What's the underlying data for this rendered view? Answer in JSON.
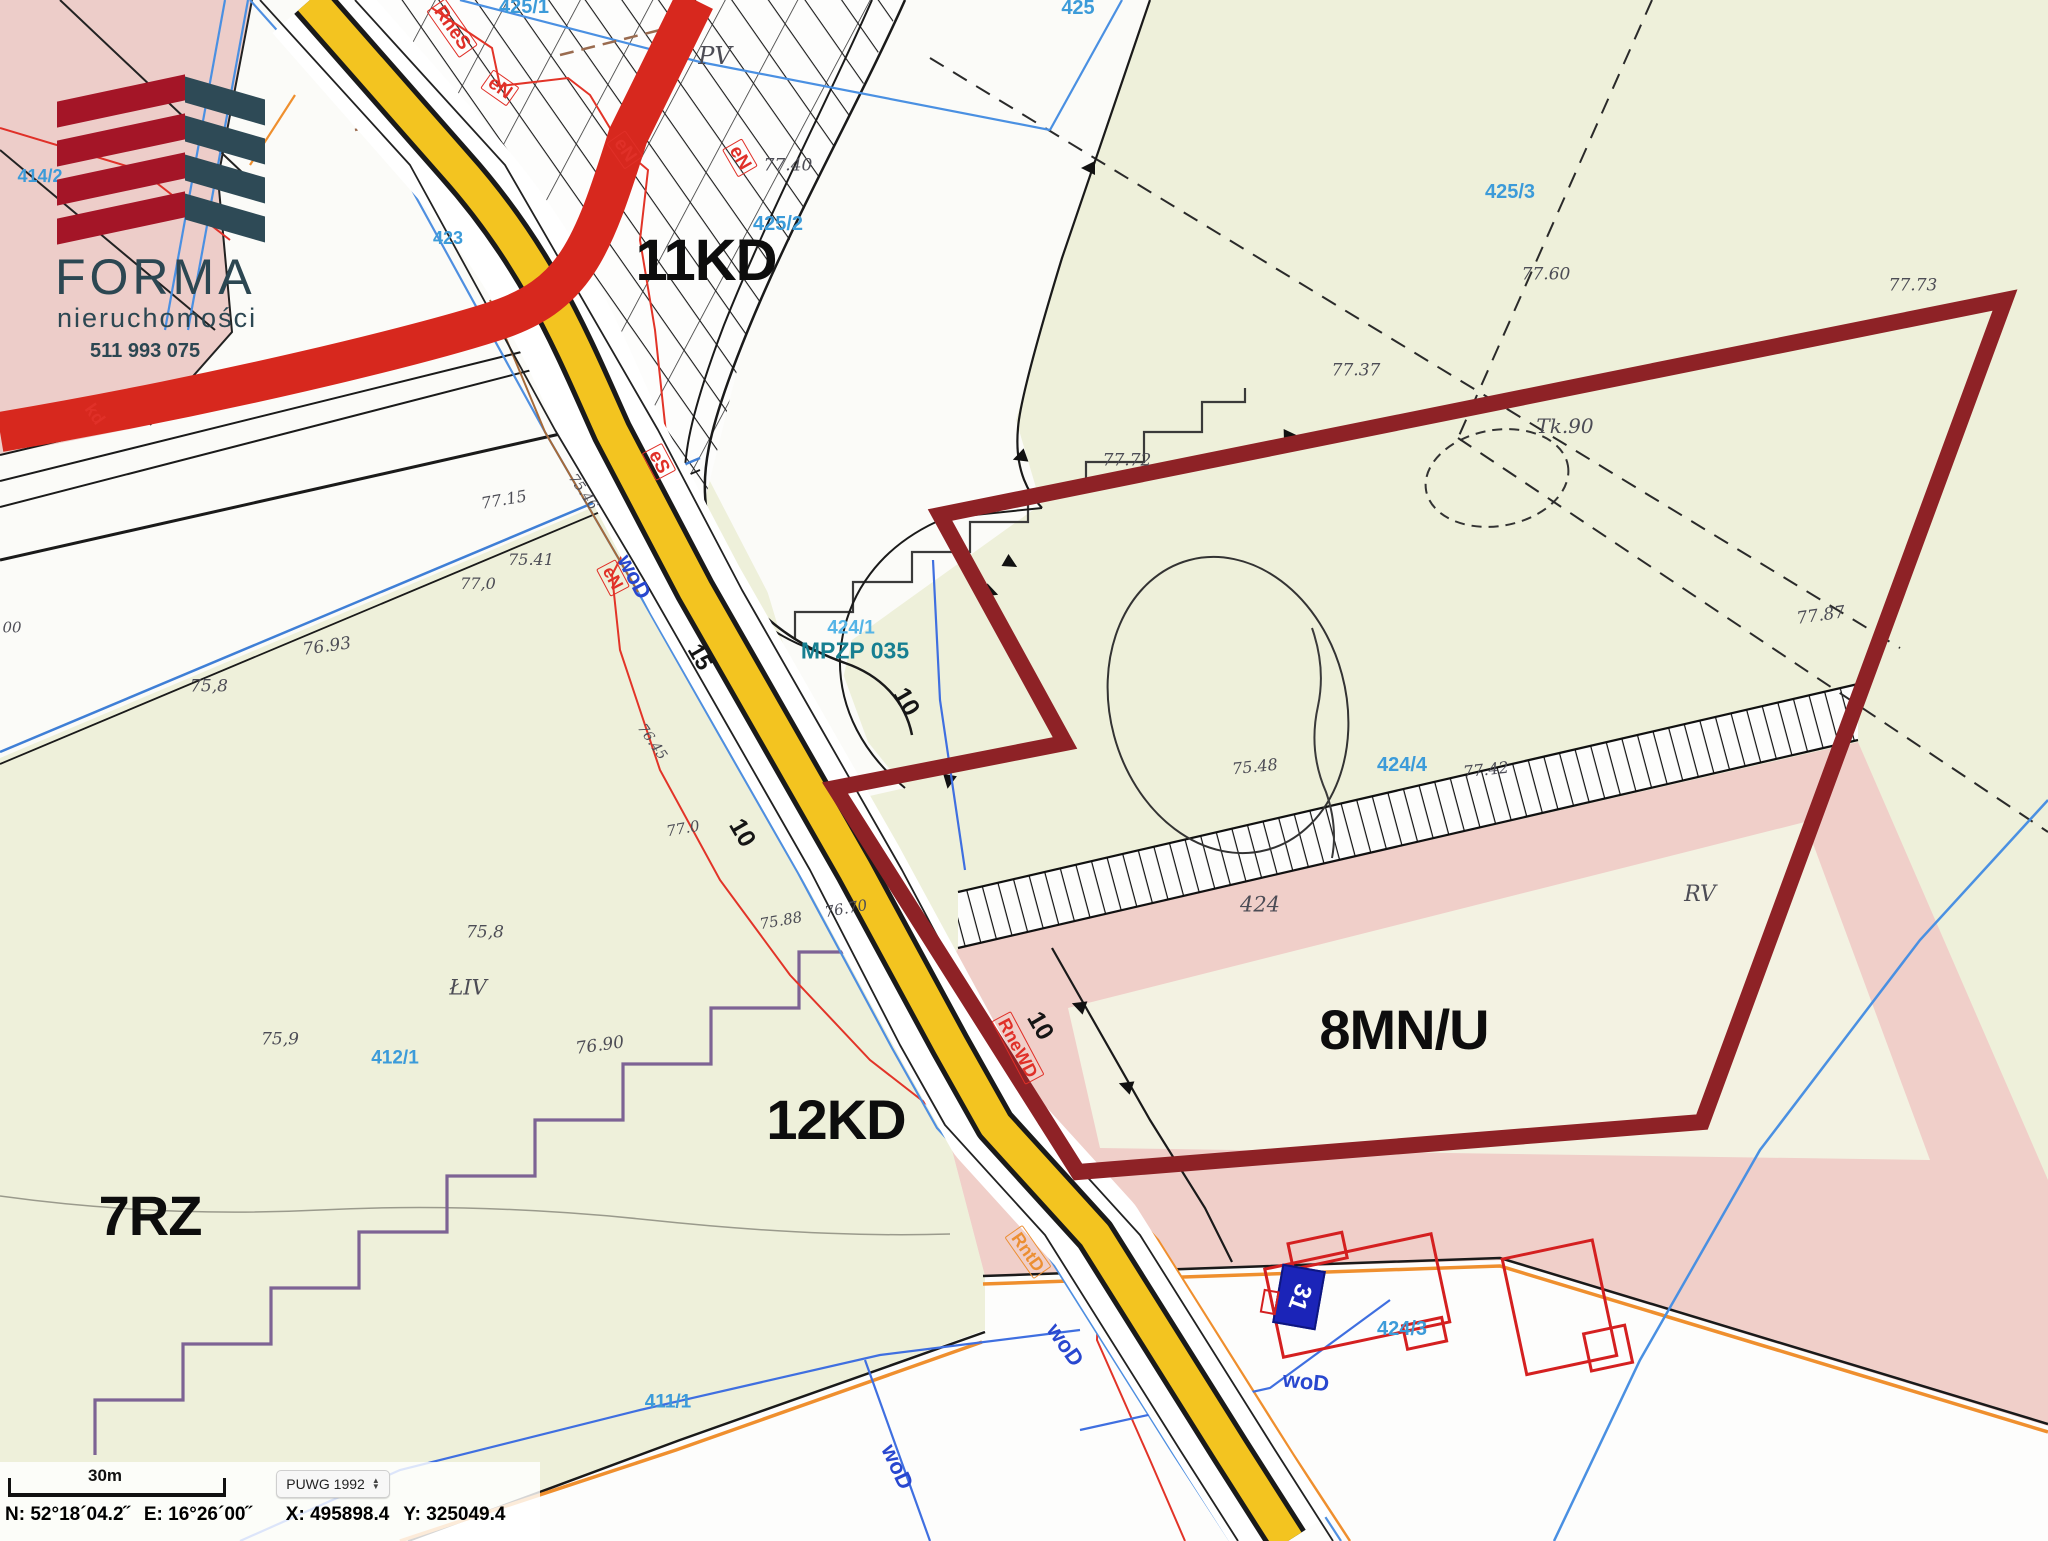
{
  "meta": {
    "title": "MPZP cadastral map extract",
    "width": 2048,
    "height": 1541
  },
  "logo": {
    "brand": "FORMA",
    "subtitle": "nieruchomości",
    "phone": "511 993 075"
  },
  "colors": {
    "plot_outline_maroon": "#8e2226",
    "road_yellow": "#f3c420",
    "road_red": "#d7281e",
    "parcel_blue": "#3c9bd9",
    "mpzp_teal": "#177f91",
    "zone_pink": "#f0cfc9",
    "zone_green": "#eef0da",
    "logo_red": "#a41527",
    "logo_teal": "#2e4a56",
    "utility_red": "#e03028",
    "utility_blue": "#2847cf",
    "utility_orange": "#ec8f33",
    "address_box_blue": "#1b24b8"
  },
  "map": {
    "address_number": "31"
  },
  "icons": {
    "arrow_up": "▲",
    "arrow_down": "▼"
  },
  "status_bar": {
    "scale_label": "30m",
    "crs_value": "PUWG 1992",
    "coords": {
      "n_label": "N:",
      "n": "52°18´04.2˝",
      "e_label": "E:",
      "e": "16°26´00˝",
      "x_label": "X:",
      "x": "495898.4",
      "y_label": "Y:",
      "y": "325049.4"
    }
  },
  "map_labels": [
    {
      "id": "zone-11kd",
      "t": "11KD",
      "x": 706,
      "y": 261,
      "s": 58,
      "c": "zone"
    },
    {
      "id": "zone-12kd",
      "t": "12KD",
      "x": 836,
      "y": 1120,
      "s": 56,
      "c": "zone"
    },
    {
      "id": "zone-7rz",
      "t": "7RZ",
      "x": 150,
      "y": 1216,
      "s": 56,
      "c": "zone"
    },
    {
      "id": "zone-8mnu",
      "t": "8MN/U",
      "x": 1404,
      "y": 1030,
      "s": 56,
      "c": "zone"
    },
    {
      "id": "parcel-425",
      "t": "425",
      "x": 1078,
      "y": 8,
      "s": 20,
      "c": "parcel"
    },
    {
      "id": "parcel-425-1",
      "t": "425/1",
      "x": 524,
      "y": 7,
      "s": 20,
      "c": "parcel"
    },
    {
      "id": "parcel-425-2",
      "t": "425/2",
      "x": 778,
      "y": 224,
      "s": 20,
      "c": "parcel"
    },
    {
      "id": "parcel-425-3",
      "t": "425/3",
      "x": 1510,
      "y": 192,
      "s": 20,
      "c": "parcel"
    },
    {
      "id": "parcel-424-1",
      "t": "424/1",
      "x": 851,
      "y": 628,
      "s": 19,
      "c": "parcel2"
    },
    {
      "id": "parcel-424-4",
      "t": "424/4",
      "x": 1402,
      "y": 765,
      "s": 20,
      "c": "parcel"
    },
    {
      "id": "parcel-424-3",
      "t": "424/3",
      "x": 1402,
      "y": 1329,
      "s": 20,
      "c": "parcel"
    },
    {
      "id": "parcel-412-1",
      "t": "412/1",
      "x": 395,
      "y": 1058,
      "s": 19,
      "c": "parcel"
    },
    {
      "id": "parcel-411-1",
      "t": "411/1",
      "x": 668,
      "y": 1402,
      "s": 19,
      "c": "parcel"
    },
    {
      "id": "parcel-423",
      "t": "423",
      "x": 448,
      "y": 238,
      "s": 18,
      "c": "parcel"
    },
    {
      "id": "parcel-414-2",
      "t": "414/2",
      "x": 40,
      "y": 176,
      "s": 18,
      "c": "parcel"
    },
    {
      "id": "mpzp-ref",
      "t": "MPZP 035",
      "x": 855,
      "y": 651,
      "s": 23,
      "c": "mpzp"
    },
    {
      "id": "util-rnes",
      "t": "RneS",
      "x": 452,
      "y": 28,
      "s": 19,
      "c": "ured",
      "r": 55,
      "box": 1
    },
    {
      "id": "util-en-1",
      "t": "eN",
      "x": 500,
      "y": 88,
      "s": 19,
      "c": "ured",
      "r": 35,
      "box": 1
    },
    {
      "id": "util-en-2",
      "t": "eN",
      "x": 625,
      "y": 150,
      "s": 19,
      "c": "ured",
      "r": 55,
      "box": 1
    },
    {
      "id": "util-en-3",
      "t": "eN",
      "x": 740,
      "y": 158,
      "s": 19,
      "c": "ured",
      "r": 60,
      "box": 1
    },
    {
      "id": "util-es",
      "t": "eS",
      "x": 659,
      "y": 462,
      "s": 19,
      "c": "ured",
      "r": 62,
      "box": 1
    },
    {
      "id": "util-en-4",
      "t": "eN",
      "x": 613,
      "y": 578,
      "s": 18,
      "c": "ured",
      "r": 62,
      "box": 1
    },
    {
      "id": "util-rnewd",
      "t": "RneWD",
      "x": 1018,
      "y": 1048,
      "s": 18,
      "c": "ured",
      "r": 62,
      "box": 1
    },
    {
      "id": "util-kd",
      "t": "kd",
      "x": 95,
      "y": 414,
      "s": 18,
      "c": "ured",
      "r": 55
    },
    {
      "id": "util-rntd",
      "t": "RntD",
      "x": 1028,
      "y": 1252,
      "s": 18,
      "c": "uorange",
      "r": 55,
      "box": 1
    },
    {
      "id": "util-wod-1",
      "t": "woD",
      "x": 634,
      "y": 577,
      "s": 22,
      "c": "ublue",
      "r": 62
    },
    {
      "id": "util-wod-2",
      "t": "woD",
      "x": 1065,
      "y": 1345,
      "s": 22,
      "c": "ublue",
      "r": 55
    },
    {
      "id": "util-wod-3",
      "t": "woD",
      "x": 897,
      "y": 1467,
      "s": 22,
      "c": "ublue",
      "r": 65
    },
    {
      "id": "util-wod-4",
      "t": "woD",
      "x": 1306,
      "y": 1382,
      "s": 22,
      "c": "ublue",
      "r": 6
    },
    {
      "id": "dim-10-a",
      "t": "10",
      "x": 906,
      "y": 702,
      "s": 25,
      "c": "dim",
      "r": 60
    },
    {
      "id": "dim-10-b",
      "t": "10",
      "x": 1040,
      "y": 1026,
      "s": 25,
      "c": "dim",
      "r": 60
    },
    {
      "id": "dim-10-c",
      "t": "10",
      "x": 742,
      "y": 833,
      "s": 25,
      "c": "dim",
      "r": 60
    },
    {
      "id": "dim-15",
      "t": "15",
      "x": 700,
      "y": 657,
      "s": 23,
      "c": "dim",
      "r": 60
    },
    {
      "id": "hand-7740",
      "t": "77.40",
      "x": 788,
      "y": 166,
      "s": 17,
      "c": "hand",
      "i": 1
    },
    {
      "id": "hand-7737",
      "t": "77.37",
      "x": 1356,
      "y": 371,
      "s": 17,
      "c": "hand",
      "i": 1
    },
    {
      "id": "hand-7760",
      "t": "77.60",
      "x": 1546,
      "y": 275,
      "s": 17,
      "c": "hand",
      "i": 1
    },
    {
      "id": "hand-7773",
      "t": "77.73",
      "x": 1913,
      "y": 286,
      "s": 17,
      "c": "hand",
      "i": 1
    },
    {
      "id": "hand-tk90",
      "t": "Tk.90",
      "x": 1565,
      "y": 426,
      "s": 20,
      "c": "hand",
      "i": 1
    },
    {
      "id": "hand-7772",
      "t": "77.72",
      "x": 1127,
      "y": 461,
      "s": 17,
      "c": "hand",
      "i": 1
    },
    {
      "id": "hand-7787",
      "t": "77.87",
      "x": 1821,
      "y": 616,
      "s": 17,
      "c": "hand",
      "i": 1,
      "r": -8
    },
    {
      "id": "hand-7715",
      "t": "77.15",
      "x": 504,
      "y": 500,
      "s": 16,
      "c": "hand",
      "i": 1,
      "r": -10
    },
    {
      "id": "hand-7541",
      "t": "75.41",
      "x": 531,
      "y": 560,
      "s": 16,
      "c": "hand",
      "i": 1
    },
    {
      "id": "hand-770a",
      "t": "77,0",
      "x": 478,
      "y": 584,
      "s": 16,
      "c": "hand",
      "i": 1
    },
    {
      "id": "hand-7693",
      "t": "76.93",
      "x": 327,
      "y": 647,
      "s": 17,
      "c": "hand",
      "i": 1,
      "r": -8
    },
    {
      "id": "hand-758a",
      "t": "75,8",
      "x": 209,
      "y": 687,
      "s": 17,
      "c": "hand",
      "i": 1
    },
    {
      "id": "hand-758b",
      "t": "75,8",
      "x": 485,
      "y": 933,
      "s": 17,
      "c": "hand",
      "i": 1
    },
    {
      "id": "hand-759",
      "t": "75,9",
      "x": 280,
      "y": 1040,
      "s": 17,
      "c": "hand",
      "i": 1
    },
    {
      "id": "hand-7690",
      "t": "76.90",
      "x": 600,
      "y": 1046,
      "s": 17,
      "c": "hand",
      "i": 1,
      "r": -8
    },
    {
      "id": "hand-liv",
      "t": "ŁIV",
      "x": 468,
      "y": 988,
      "s": 21,
      "c": "hand",
      "i": 1
    },
    {
      "id": "hand-rv",
      "t": "RV",
      "x": 1700,
      "y": 895,
      "s": 22,
      "c": "hand",
      "i": 1
    },
    {
      "id": "hand-424",
      "t": "424",
      "x": 1260,
      "y": 905,
      "s": 21,
      "c": "hand",
      "i": 1
    },
    {
      "id": "hand-7548",
      "t": "75.48",
      "x": 1255,
      "y": 767,
      "s": 16,
      "c": "hand",
      "i": 1,
      "r": -6
    },
    {
      "id": "hand-7742",
      "t": "77.42",
      "x": 1486,
      "y": 770,
      "s": 16,
      "c": "hand",
      "i": 1,
      "r": -6
    },
    {
      "id": "hand-7588",
      "t": "75.88",
      "x": 781,
      "y": 921,
      "s": 15,
      "c": "hand",
      "i": 1,
      "r": -10
    },
    {
      "id": "hand-7670",
      "t": "76.70",
      "x": 846,
      "y": 909,
      "s": 15,
      "c": "hand",
      "i": 1,
      "r": -10
    },
    {
      "id": "hand-770b",
      "t": "77.0",
      "x": 683,
      "y": 829,
      "s": 15,
      "c": "hand",
      "i": 1,
      "r": -10
    },
    {
      "id": "hand-pv",
      "t": "PV",
      "x": 715,
      "y": 56,
      "s": 24,
      "c": "hand",
      "i": 1
    },
    {
      "id": "hand-00",
      "t": "00",
      "x": 12,
      "y": 628,
      "s": 15,
      "c": "hand",
      "i": 1
    },
    {
      "id": "hand-7645",
      "t": "76.45",
      "x": 652,
      "y": 742,
      "s": 14,
      "c": "hand",
      "i": 1,
      "r": 55
    },
    {
      "id": "hand-7546",
      "t": "75.46",
      "x": 583,
      "y": 492,
      "s": 14,
      "c": "hand",
      "i": 1,
      "r": 55
    }
  ]
}
